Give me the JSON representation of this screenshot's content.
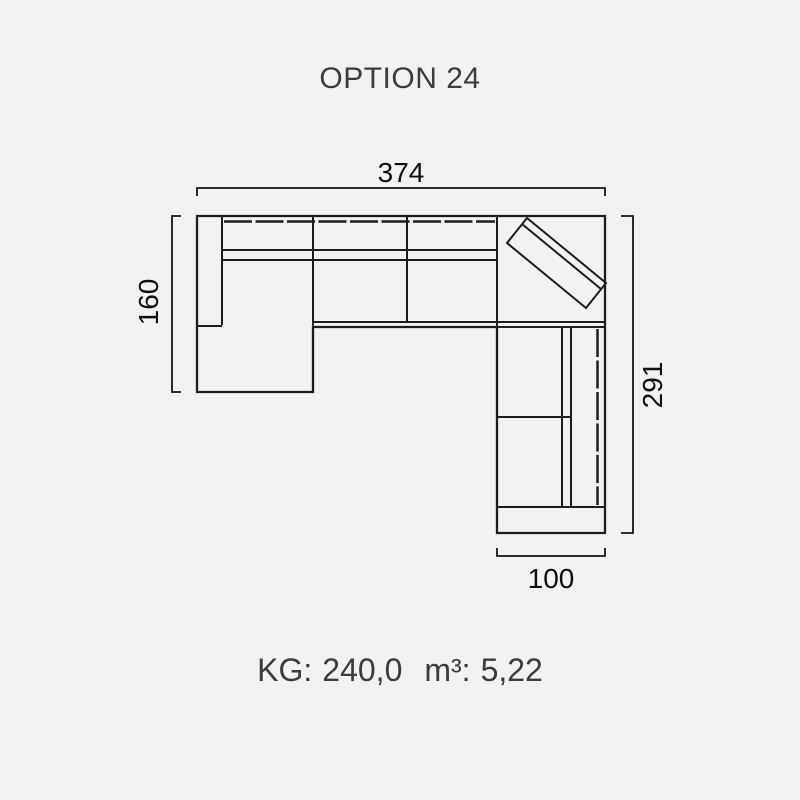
{
  "title": "OPTION 24",
  "diagram": {
    "type": "sofa-sectional-top-view",
    "dimensions_cm": {
      "total_width": "374",
      "chaise_depth": "160",
      "total_height": "291",
      "wing_width": "100"
    },
    "colors": {
      "background": "#f1f2f1",
      "line": "#1c1c1c",
      "dimension_text": "#0e0e0e",
      "label_text": "#3b3b3b"
    }
  },
  "footer": {
    "weight_label": "KG:",
    "weight_value": "240,0",
    "volume_label": "m³:",
    "volume_value": "5,22"
  }
}
